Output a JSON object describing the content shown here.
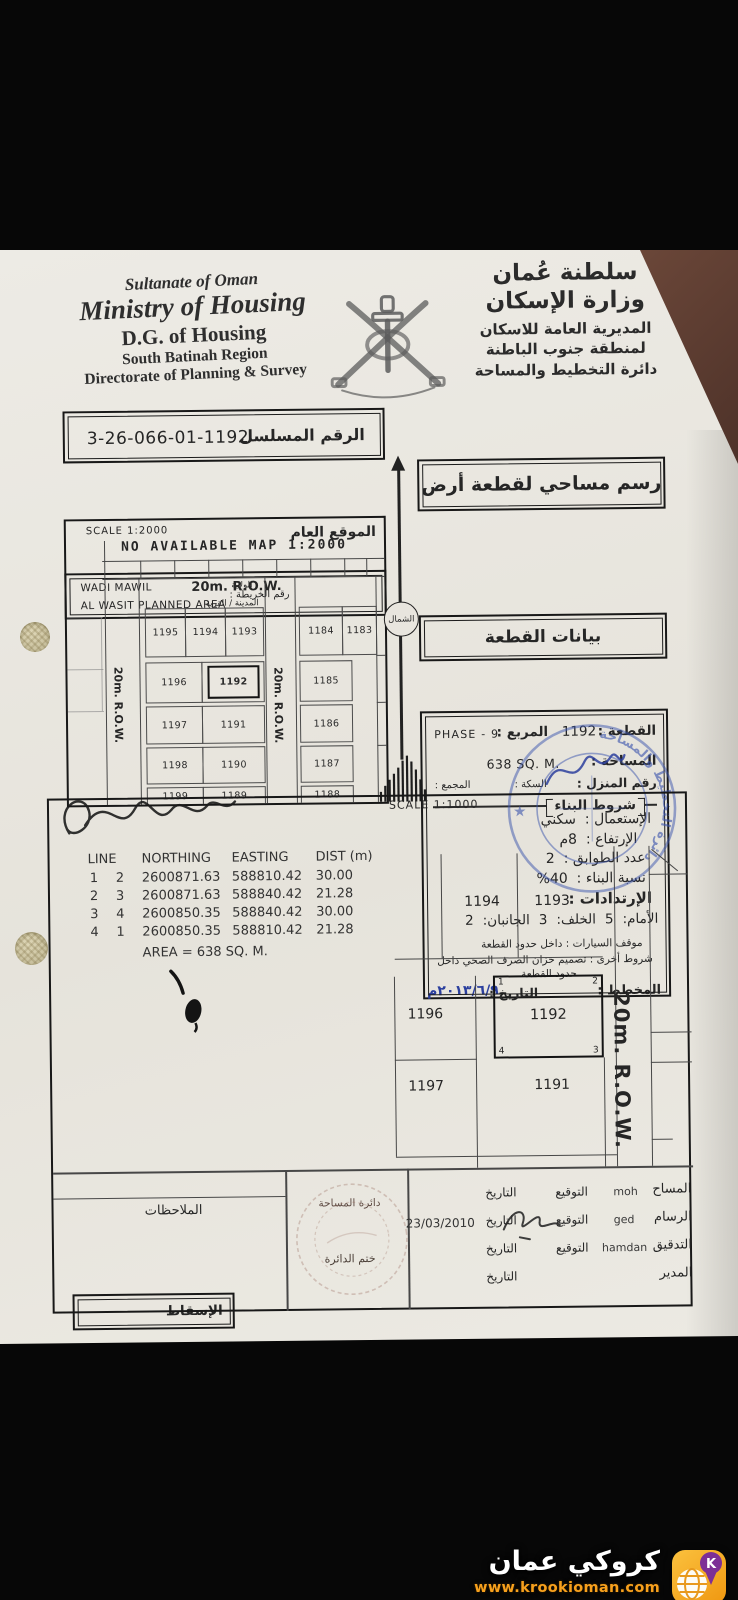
{
  "header": {
    "english": [
      "Sultanate of Oman",
      "Ministry of Housing",
      "D.G. of Housing",
      "South Batinah Region",
      "Directorate of Planning & Survey"
    ],
    "arabic": [
      "سلطنة عُمان",
      "وزارة الإسكان",
      "المديرية العامة للاسكان",
      "لمنطقة جنوب الباطنة",
      "دائرة التخطيط والمساحة"
    ]
  },
  "serial": {
    "label": "الرقم المسلسل",
    "value": "3-26-066-01-1192"
  },
  "title_box": "رسم مساحي لقطعة أرض",
  "plot_info_title": "بيانات القطعة",
  "location": {
    "line1": "WADI MAWIL",
    "line2": "AL WASIT PLANNED AREA",
    "map_no_label": "رقم الخريطة :",
    "wilaya_label": "الولاية",
    "town_label": "المدينة / القرية"
  },
  "overview_map": {
    "scale": "SCALE 1:2000",
    "no_map": "NO AVAILABLE MAP 1:2000",
    "title": "الموقع العام",
    "row_h": "20m. R.O.W.",
    "row_v_left": "20m. R.O.W.",
    "row_v_mid": "20m. R.O.W.",
    "north": "الشمال",
    "plots_left": [
      "1195",
      "1194",
      "1193",
      "1196",
      "1192",
      "1197",
      "1191",
      "1198",
      "1190",
      "1199",
      "1189"
    ],
    "plots_right": [
      "1184",
      "1183",
      "1185",
      "1186",
      "1187",
      "1188"
    ]
  },
  "info": {
    "plot_label": "القطعة :",
    "plot_value": "1192",
    "square_label": "المربع :",
    "square_value": "PHASE - 9",
    "area_label": "المساحة :",
    "area_value": "638 SQ. M.",
    "house_no_label": "رقم المنزل :",
    "street_label": "السكة :",
    "complex_label": "المجمع :",
    "conditions_title": "شروط البناء",
    "use_label": "الإستعمال :",
    "use_value": "سكني",
    "height_label": "الإرتفاع :",
    "height_value": "8م",
    "floors_label": "عدد الطوابق :",
    "floors_value": "2",
    "ratio_label": "نسبة البناء :",
    "ratio_value": "40%",
    "setbacks_title": "الإرتدادات :",
    "front_label": "الأمام:",
    "front_value": "5",
    "back_label": "الخلف:",
    "back_value": "3",
    "sides_label": "الجانبان:",
    "sides_value": "2",
    "parking_line": "موقف السيارات : داخل حدود القطعة",
    "other_line1": "شروط أخرى : تصميم خزان الصرف الصحي داخل",
    "other_line2": "حدود القطعة",
    "planner_label": "المخطط :",
    "date_label": "التاريخ :",
    "date_value": "٢٠١٣/٦/٩م"
  },
  "stamps": {
    "blue_text": "دائرة التخطيط والمساحة"
  },
  "esqat_label": "الإسقاط",
  "coordinates": {
    "headers": [
      "LINE",
      "NORTHING",
      "EASTING",
      "DIST (m)"
    ],
    "rows": [
      [
        "1",
        "2",
        "2600871.63",
        "588810.42",
        "30.00"
      ],
      [
        "2",
        "3",
        "2600871.63",
        "588840.42",
        "21.28"
      ],
      [
        "3",
        "4",
        "2600850.35",
        "588840.42",
        "30.00"
      ],
      [
        "4",
        "1",
        "2600850.35",
        "588810.42",
        "21.28"
      ]
    ],
    "area": "AREA = 638 SQ. M."
  },
  "detail_map": {
    "scale": "SCALE 1:1000",
    "plots": [
      "1194",
      "1193",
      "1196",
      "1192",
      "1197",
      "1191"
    ],
    "corners": [
      "1",
      "2",
      "3",
      "4"
    ],
    "row": "20m. R.O.W."
  },
  "signatures": {
    "notes_label": "الملاحظات",
    "stamp_dept": "دائرة المساحة",
    "stamp_label": "ختم الدائرة",
    "sig_label": "التوقيع",
    "date_label": "التاريخ",
    "rows": [
      {
        "role": "المساح",
        "name": "moh",
        "date": ""
      },
      {
        "role": "الرسام",
        "name": "ged",
        "date": "23/03/2010"
      },
      {
        "role": "التدقيق",
        "name": "hamdan",
        "date": ""
      },
      {
        "role": "المدير",
        "name": "",
        "date": ""
      }
    ]
  },
  "watermark": {
    "title": "كروكي عمان",
    "url": "www.krookioman.com",
    "icon_letter": "K"
  }
}
